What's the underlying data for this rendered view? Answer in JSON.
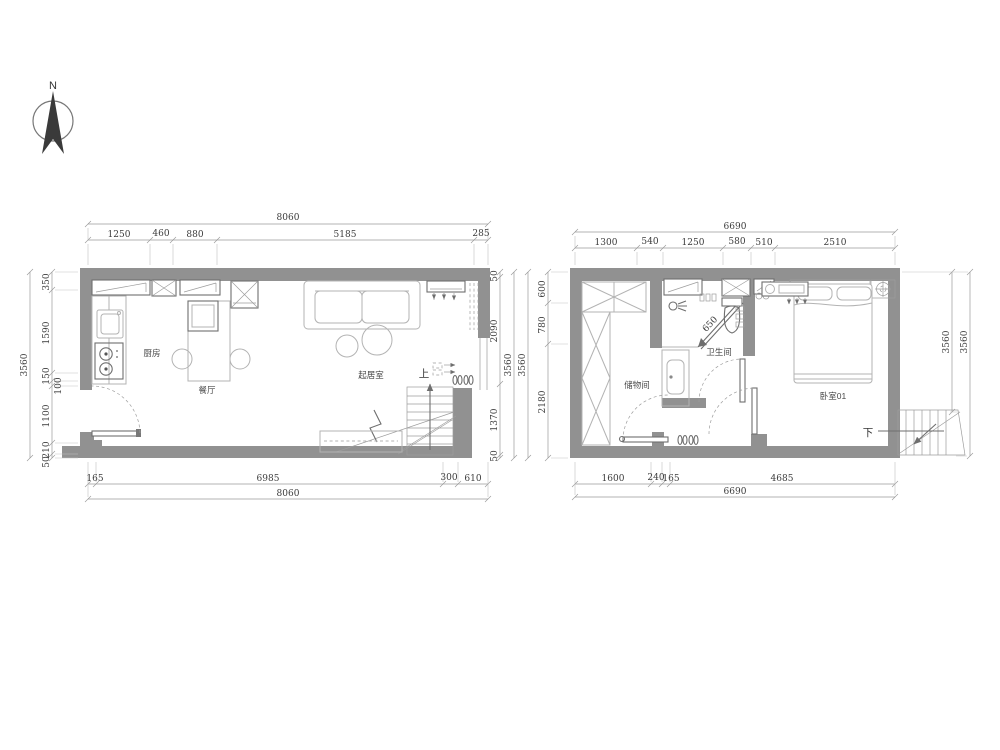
{
  "compass": {
    "label": "N"
  },
  "colors": {
    "wall": "#919191",
    "furniture_line": "#b3b3b3",
    "dim_line": "#9a9a9a",
    "dim_text": "#3b3b3b"
  },
  "left_plan": {
    "rooms": {
      "kitchen": "厨房",
      "dining": "餐厅",
      "living": "起居室"
    },
    "stair_direction": "上",
    "dims": {
      "top_total": "8060",
      "top": [
        "1250",
        "460",
        "880",
        "5185",
        "285"
      ],
      "bottom": [
        "165",
        "6985",
        "300",
        "610"
      ],
      "bottom_total": "8060",
      "left_total": "3560",
      "left": [
        "350",
        "1590",
        "150",
        "100",
        "1100",
        "210",
        "50"
      ],
      "right": [
        "50",
        "2090",
        "1370",
        "50"
      ],
      "right_total": "3560"
    }
  },
  "right_plan": {
    "rooms": {
      "storage": "储物间",
      "bathroom": "卫生间",
      "bedroom": "卧室01"
    },
    "stair_direction": "下",
    "shower_door_width": "650",
    "dims": {
      "top_total": "6690",
      "top": [
        "1300",
        "540",
        "1250",
        "580",
        "510",
        "2510"
      ],
      "bottom": [
        "1600",
        "240",
        "165",
        "4685"
      ],
      "bottom_total": "6690",
      "left_outer_total": "3560",
      "left": [
        "600",
        "780",
        "2180"
      ],
      "right_totals": [
        "3560",
        "3560"
      ]
    }
  }
}
